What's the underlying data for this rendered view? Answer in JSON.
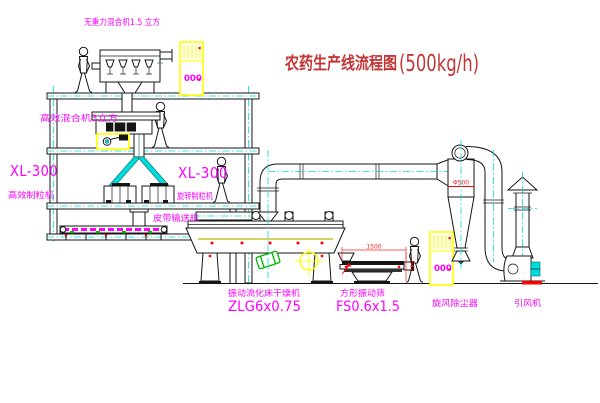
{
  "title": {
    "cn": "农药生产线流程图",
    "capacity": "(500kg/h)"
  },
  "labels": {
    "top_mixer": "无重力混合机1.5 立方",
    "floor2_mixer": "高效混合机3立方",
    "left_model": "XL-300",
    "left_machine": "高效制粒机",
    "mid_model": "XL-300",
    "mid_machine": "旋转制粒机",
    "belt_conveyor": "皮带输送机",
    "dryer_name": "振动流化床干燥机",
    "dryer_model": "ZLG6x0.75",
    "screen_name": "方形振动筛",
    "screen_model": "FS0.6x1.5",
    "cyclone": "旋风除尘器",
    "fan": "引风机",
    "cabinet_display": "000"
  },
  "dimensions": {
    "screen_length": "1500",
    "screen_height": "541",
    "cyclone_diameter": "Φ500"
  },
  "colors": {
    "label_magenta": "#ff00ff",
    "title_red": "#c43535",
    "dim_red": "#ff2020",
    "centerline_cyan": "#00dcdc",
    "cabinet_yellow": "#ffff00",
    "motor_green": "#00b400",
    "accent_red": "#ff0000",
    "belt_magenta": "#ff00ff",
    "highlight_yellow": "#ffff00",
    "line_black": "#161616"
  }
}
